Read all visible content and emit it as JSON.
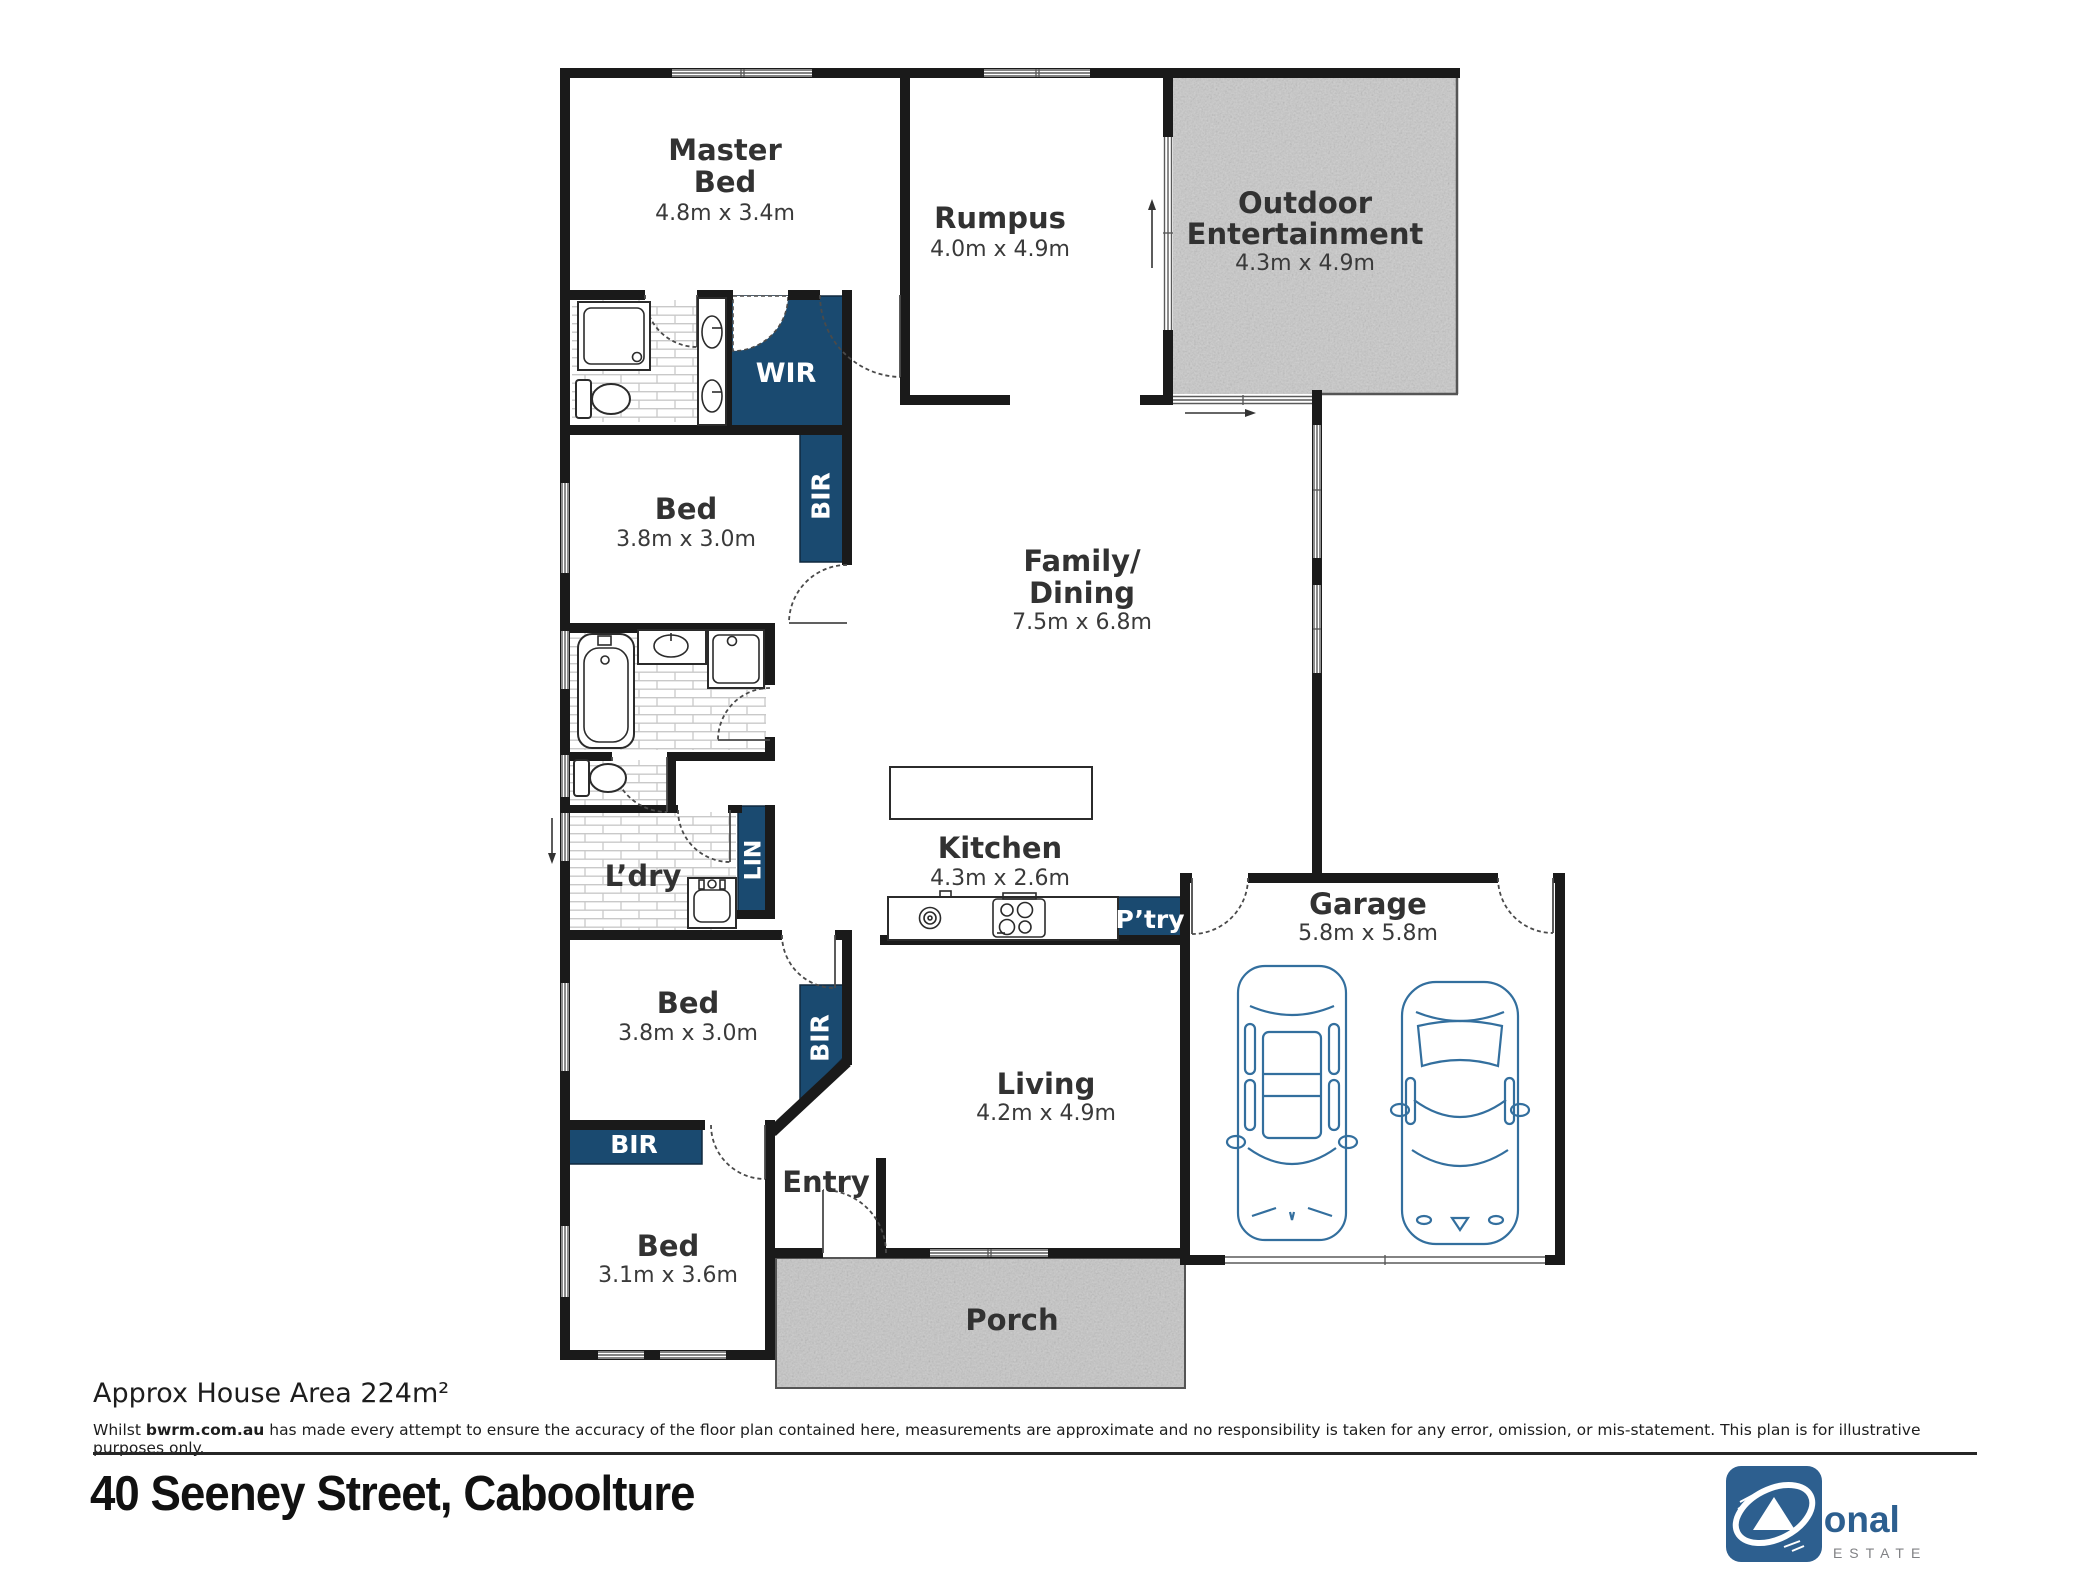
{
  "plan": {
    "rooms": {
      "master": {
        "lines": [
          "Master",
          "Bed",
          "4.8m x 3.4m"
        ]
      },
      "rumpus": {
        "lines": [
          "Rumpus",
          "4.0m x 4.9m"
        ]
      },
      "outdoor": {
        "lines": [
          "Outdoor",
          "Entertainment",
          "4.3m x 4.9m"
        ]
      },
      "family": {
        "lines": [
          "Family/",
          "Dining",
          "7.5m x 6.8m"
        ]
      },
      "kitchen": {
        "lines": [
          "Kitchen",
          "4.3m x 2.6m"
        ]
      },
      "garage": {
        "lines": [
          "Garage",
          "5.8m x 5.8m"
        ]
      },
      "living": {
        "lines": [
          "Living",
          "4.2m x 4.9m"
        ]
      },
      "bed2": {
        "lines": [
          "Bed",
          "3.8m x 3.0m"
        ]
      },
      "bed3": {
        "lines": [
          "Bed",
          "3.8m x 3.0m"
        ]
      },
      "bed4": {
        "lines": [
          "Bed",
          "3.1m x 3.6m"
        ]
      },
      "laundry": {
        "lines": [
          "L’dry"
        ]
      },
      "entry": {
        "lines": [
          "Entry"
        ]
      },
      "porch": {
        "lines": [
          "Porch"
        ]
      }
    },
    "closets": {
      "wir": "WIR",
      "bir": "BIR",
      "lin": "LIN",
      "pantry": "P’try"
    }
  },
  "footer": {
    "area_text": "Approx House Area 224m²",
    "disclaimer_prefix": "Whilst ",
    "disclaimer_bold": "bwrm.com.au",
    "disclaimer_rest": " has made every attempt to ensure the accuracy of the floor plan contained here, measurements are approximate and no responsibility is taken for any error, omission, or mis-statement. This plan is for illustrative purposes only.",
    "address": "40 Seeney Street, Caboolture"
  },
  "branding": {
    "line1": "first",
    "line2": "national",
    "line3": "REAL ESTATE"
  },
  "colors": {
    "wall": "#1a1a1a",
    "closet_navy": "#1a4a70",
    "car_outline": "#336f9e",
    "concrete": "#c9c9c9",
    "brand_blue": "#2d5f8f",
    "brand_gray": "#58595b"
  }
}
